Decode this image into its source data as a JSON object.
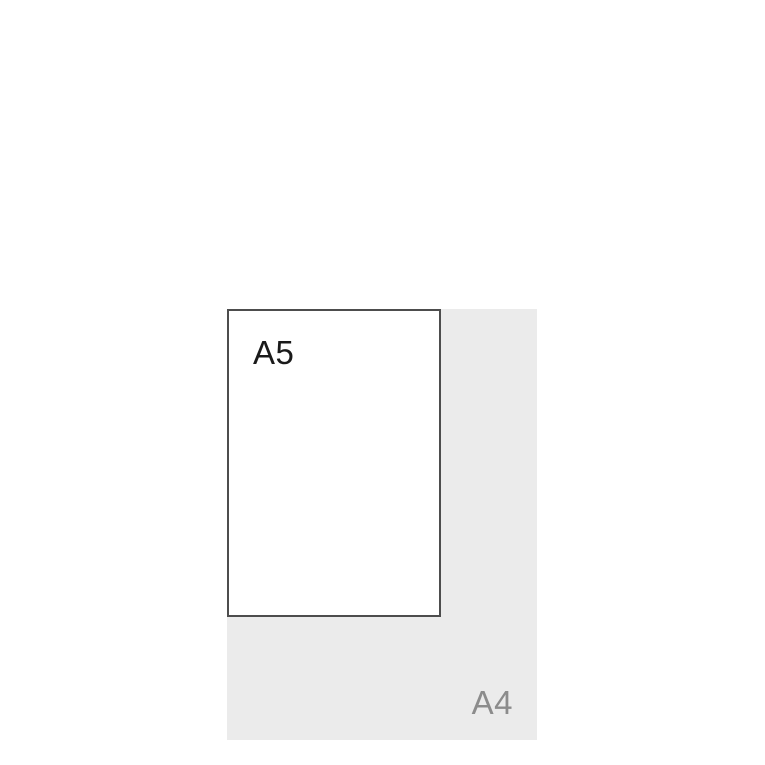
{
  "diagram": {
    "title": "paper-size-comparison",
    "sheets": [
      {
        "id": "a4",
        "label": "A4",
        "fill": "#ebebeb",
        "label_color": "#8c8c8c",
        "label_position": "bottom-right"
      },
      {
        "id": "a5",
        "label": "A5",
        "fill": "#ffffff",
        "border_color": "#4d4d4d",
        "label_color": "#1a1a1a",
        "label_position": "top-left"
      }
    ]
  },
  "colors": {
    "canvas_background": "#ffffff",
    "a4_fill": "#ebebeb",
    "a5_fill": "#ffffff",
    "a5_border": "#4d4d4d",
    "a5_label": "#1a1a1a",
    "a4_label": "#8c8c8c"
  }
}
